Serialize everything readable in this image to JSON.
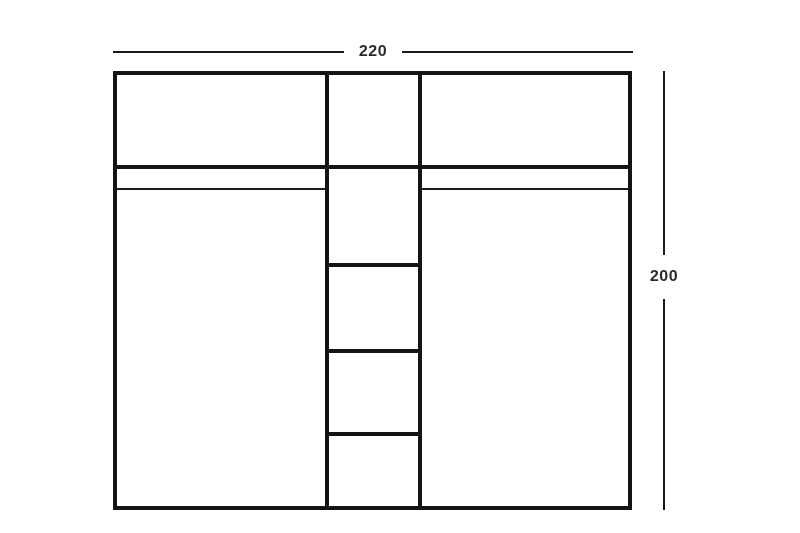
{
  "diagram": {
    "kind": "furniture-front-elevation",
    "subject": "wardrobe with two door panels and a center column of five shelf compartments",
    "dimensions": {
      "width_label": "220",
      "height_label": "200"
    },
    "structure": {
      "left_section": {
        "parts": [
          "top-compartment",
          "thick-divider",
          "thin-trim-line",
          "door-panel"
        ]
      },
      "center_section": {
        "shelf_compartments": 5,
        "divider_count": 4
      },
      "right_section": {
        "parts": [
          "top-compartment",
          "thick-divider",
          "thin-trim-line",
          "door-panel"
        ]
      }
    },
    "colors": {
      "line": "#141414",
      "label_text": "#2a2a2a",
      "background": "#ffffff"
    }
  }
}
